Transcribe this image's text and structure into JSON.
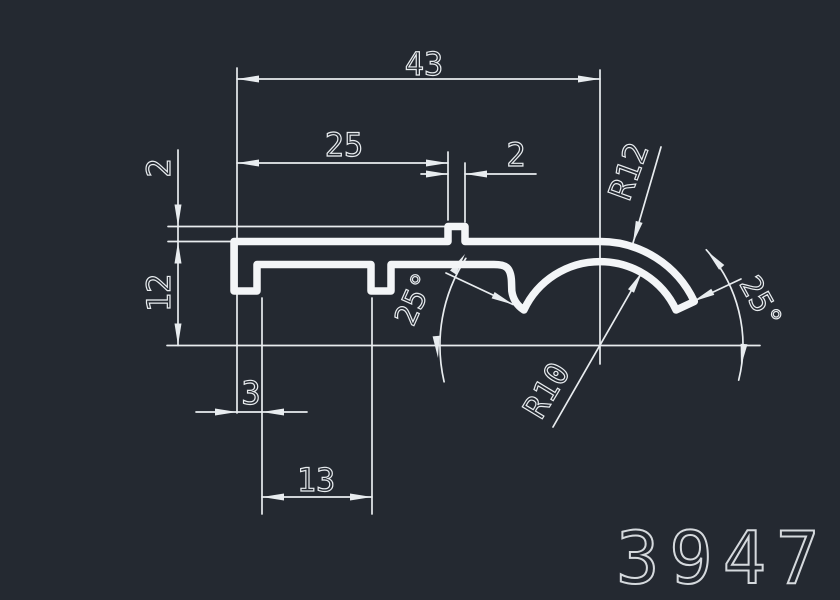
{
  "drawing": {
    "part_number": "3947",
    "dimensions": {
      "overall_width": "43",
      "flat_width": "25",
      "rib_width": "2",
      "rib_height": "2",
      "profile_height": "12",
      "left_leg_width": "3",
      "leg_spacing": "13",
      "outer_radius": "R12",
      "inner_radius": "R10",
      "angle_left": "25°",
      "angle_right": "25°"
    },
    "colors": {
      "background": "#242931",
      "profile_line": "#f3f5f7",
      "dimension_line": "#e8ecef",
      "part_number_color": "#d5d9dd"
    }
  }
}
